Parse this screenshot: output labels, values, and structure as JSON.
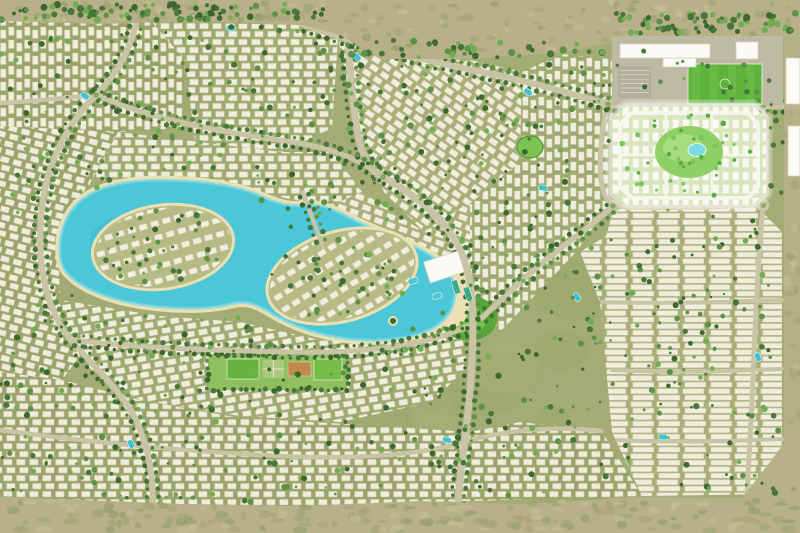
{
  "meta": {
    "kind": "aerial-masterplan",
    "subject": "rendered aerial master plan of a desert residential community with a turquoise lagoon, villa and townhouse districts, a highlighted new-phase parcel, and a school / sports complex"
  },
  "canvas": {
    "w": 800,
    "h": 533
  },
  "palette": {
    "ground": "#a4ac75",
    "groundDark": "#98a269",
    "groundLight": "#afb57e",
    "desert": "#b7b088",
    "desertDark": "#a5a276",
    "desertLight": "#c7c098",
    "scrub": "#8f9a66",
    "scrub2": "#9aa371",
    "road": "#cac4a6",
    "roadCenter": "#86a85c",
    "house": "#f3f0e2",
    "houseStroke": "#d4ceb4",
    "tree": "#47763a",
    "treeDark": "#3a682f",
    "treeLight": "#5d9147",
    "treeBright": "#70ae52",
    "water": "#4cc7d7",
    "waterDeep": "#35bccf",
    "waterLight": "#7edae4",
    "sand": "#ecdfb4",
    "parcelGround": "#d7e7bb",
    "parcelRoad": "#f6f6ef",
    "parcelPark": "#8ed066",
    "parcelParkLight": "#a7dc80",
    "pond": "#7bdbe4",
    "parcelTree": "#58ab44",
    "parcelTree2": "#7ac561",
    "field": "#5fb33c",
    "fieldLight": "#72c14c",
    "paved": "#bdbaa4",
    "parking": "#b2af9d",
    "white": "#fbfaf5",
    "bldgStroke": "#d8d4c0",
    "court": "#c08a4c",
    "lawn": "#68b33f",
    "lawnLight": "#77bd4a",
    "garden": "#a9c97c",
    "parkGreen": "#8fbf5e",
    "poolEdge": "#eef2e8"
  },
  "desert": {
    "top": "M0,0 L800,0 L800,36 L700,40 L620,41 L560,53 L470,59 L380,59 L340,35 L302,25 L200,21 L100,24 L0,21 Z",
    "bottom": "M0,533 L0,497 L80,500 L180,504 L300,506 L420,501 L520,504 L642,497 L742,498 L800,499 L800,533 Z",
    "right": "M784,36 L800,36 L800,499 L784,499 Z",
    "corner": "M800,420 C780,450 760,475 742,498 L800,499 Z",
    "topEdge": [
      [
        0,
        22
      ],
      [
        300,
        25
      ],
      [
        340,
        36
      ],
      [
        380,
        59
      ],
      [
        560,
        53
      ],
      [
        620,
        41
      ],
      [
        800,
        37
      ]
    ],
    "bottomEdge": [
      [
        0,
        496
      ],
      [
        180,
        503
      ],
      [
        300,
        505
      ],
      [
        420,
        500
      ],
      [
        642,
        496
      ],
      [
        800,
        498
      ]
    ]
  },
  "districts": [
    {
      "name": "district-top-left-a",
      "pts": [
        [
          0,
          20
        ],
        [
          152,
          22
        ],
        [
          185,
          60
        ],
        [
          182,
          128
        ],
        [
          118,
          132
        ],
        [
          0,
          126
        ]
      ],
      "angle": 90,
      "type": "villa",
      "tone": "#9aa46b"
    },
    {
      "name": "district-top-left-b",
      "pts": [
        [
          152,
          22
        ],
        [
          302,
          25
        ],
        [
          338,
          38
        ],
        [
          332,
          128
        ],
        [
          282,
          152
        ],
        [
          196,
          150
        ],
        [
          185,
          60
        ]
      ],
      "angle": 0,
      "type": "villa",
      "tone": "#a0aa70"
    },
    {
      "name": "district-top-center",
      "pts": [
        [
          338,
          38
        ],
        [
          382,
          58
        ],
        [
          470,
          60
        ],
        [
          522,
          72
        ],
        [
          520,
          162
        ],
        [
          472,
          202
        ],
        [
          424,
          232
        ],
        [
          384,
          192
        ],
        [
          356,
          122
        ]
      ],
      "angle": 35,
      "type": "villa",
      "tone": "#a7af77"
    },
    {
      "name": "district-center-right",
      "pts": [
        [
          522,
          72
        ],
        [
          562,
          54
        ],
        [
          618,
          60
        ],
        [
          612,
          104
        ],
        [
          608,
          206
        ],
        [
          576,
          252
        ],
        [
          538,
          292
        ],
        [
          500,
          332
        ],
        [
          470,
          312
        ],
        [
          442,
          252
        ],
        [
          472,
          202
        ],
        [
          520,
          162
        ]
      ],
      "angle": 90,
      "type": "villa",
      "tone": "#a0aa70"
    },
    {
      "name": "district-right-grid",
      "pts": [
        [
          614,
          208
        ],
        [
          758,
          208
        ],
        [
          782,
          232
        ],
        [
          782,
          494
        ],
        [
          642,
          496
        ],
        [
          612,
          432
        ],
        [
          600,
          302
        ],
        [
          580,
          252
        ],
        [
          606,
          236
        ]
      ],
      "angle": 0,
      "type": "town",
      "tone": "#a7af77"
    },
    {
      "name": "district-west",
      "pts": [
        [
          0,
          126
        ],
        [
          118,
          132
        ],
        [
          92,
          180
        ],
        [
          58,
          240
        ],
        [
          60,
          300
        ],
        [
          92,
          340
        ],
        [
          62,
          380
        ],
        [
          0,
          372
        ]
      ],
      "angle": 15,
      "type": "villa",
      "tone": "#9aa46b"
    },
    {
      "name": "district-north-lagoon",
      "pts": [
        [
          118,
          132
        ],
        [
          282,
          152
        ],
        [
          332,
          152
        ],
        [
          362,
          192
        ],
        [
          330,
          206
        ],
        [
          252,
          192
        ],
        [
          160,
          182
        ],
        [
          92,
          180
        ]
      ],
      "angle": 0,
      "type": "villa",
      "tone": "#a0aa70"
    },
    {
      "name": "district-south-lagoon",
      "pts": [
        [
          60,
          300
        ],
        [
          160,
          316
        ],
        [
          240,
          322
        ],
        [
          320,
          340
        ],
        [
          402,
          346
        ],
        [
          456,
          326
        ],
        [
          472,
          362
        ],
        [
          432,
          402
        ],
        [
          340,
          422
        ],
        [
          240,
          416
        ],
        [
          140,
          400
        ],
        [
          92,
          370
        ],
        [
          62,
          340
        ]
      ],
      "angle": -10,
      "type": "villa",
      "tone": "#a0aa70"
    },
    {
      "name": "district-bottom",
      "pts": [
        [
          0,
          372
        ],
        [
          62,
          380
        ],
        [
          140,
          400
        ],
        [
          240,
          418
        ],
        [
          380,
          426
        ],
        [
          470,
          432
        ],
        [
          520,
          422
        ],
        [
          602,
          432
        ],
        [
          642,
          496
        ],
        [
          300,
          506
        ],
        [
          180,
          504
        ],
        [
          80,
          500
        ],
        [
          0,
          496
        ]
      ],
      "angle": 0,
      "type": "villa",
      "tone": "#9aa46b"
    },
    {
      "name": "district-east-lagoon",
      "pts": [
        [
          362,
          192
        ],
        [
          424,
          232
        ],
        [
          470,
          202
        ],
        [
          470,
          312
        ],
        [
          456,
          326
        ],
        [
          402,
          346
        ],
        [
          330,
          340
        ],
        [
          300,
          322
        ],
        [
          330,
          206
        ]
      ],
      "angle": 20,
      "type": "villa",
      "tone": "#a7af77"
    }
  ],
  "lagoon": {
    "beach": {
      "cx": 448,
      "cy": 294,
      "rx": 22,
      "ry": 34,
      "rot": -10
    },
    "water": "M60,255 C58,224 72,202 96,191 C122,180 152,179 186,181 C221,183 246,189 263,197 C279,204 291,207 306,205 C323,203 341,213 356,221 C379,232 411,242 433,257 C451,269 459,287 453,305 C447,323 429,333 406,337 C381,342 351,341 326,335 C303,330 286,322 269,312 C256,304 246,300 231,304 C211,309 186,310 151,306 C116,302 86,291 71,277 C63,270 61,264 60,255 Z",
    "deepBlobs": [
      [
        150,
        240,
        60,
        28
      ],
      [
        330,
        283,
        55,
        25
      ]
    ],
    "islands": [
      {
        "cx": 163,
        "cy": 247,
        "rx": 71,
        "ry": 42,
        "rot": -8
      },
      {
        "cx": 342,
        "cy": 276,
        "rx": 77,
        "ry": 45,
        "rot": -16
      }
    ],
    "tiny": {
      "cx": 393,
      "cy": 321,
      "r": 5
    }
  },
  "roads": [
    {
      "name": "main-boulevard",
      "d": "M345,0 C350,60 352,120 362,150 C370,170 376,174 383,177",
      "w": 7,
      "trees": true
    },
    {
      "name": "east-artery",
      "d": "M383,177 C412,192 440,216 455,240 C468,262 473,290 473,320 C473,370 468,420 461,470 C458,494 457,512 457,533",
      "w": 7,
      "trees": true
    },
    {
      "name": "top-cross-road",
      "d": "M302,24 C362,46 432,62 482,72 C532,82 572,94 608,104 C652,110 702,108 763,106 C780,106 792,107 800,107",
      "w": 6,
      "trees": true
    },
    {
      "name": "parcel-left-road",
      "d": "M608,104 C601,130 599,160 601,180 C603,194 607,200 613,206",
      "w": 5,
      "trees": false
    },
    {
      "name": "parcel-bottom-road",
      "d": "M613,206 C660,209 712,207 763,205",
      "w": 5,
      "trees": false
    },
    {
      "name": "parcel-right-road",
      "d": "M763,106 C766,140 767,174 763,205",
      "w": 5,
      "trees": false
    },
    {
      "name": "parcel-diagonal-road",
      "d": "M613,206 C592,226 562,246 536,268 C516,286 496,304 482,318",
      "w": 5.5,
      "trees": true
    },
    {
      "name": "right-vertical-road",
      "d": "M763,205 C758,260 755,330 752,400 C750,440 748,472 747,498",
      "w": 5,
      "trees": false
    },
    {
      "name": "west-loop-road",
      "d": "M140,0 C136,40 121,70 96,95 C66,125 46,165 41,215 C37,265 46,310 71,340 C96,370 121,390 136,420 C149,448 153,475 153,505",
      "w": 6,
      "trees": true
    },
    {
      "name": "west-horizontal-road",
      "d": "M0,103 C30,102 60,98 96,95",
      "w": 4.5,
      "trees": false
    },
    {
      "name": "north-shore-road",
      "d": "M96,95 C152,120 222,132 292,142 C332,148 362,160 383,177",
      "w": 5,
      "trees": true
    },
    {
      "name": "south-shore-road",
      "d": "M71,340 C140,348 212,350 282,352 C352,354 422,348 468,326",
      "w": 5,
      "trees": true
    },
    {
      "name": "bottom-collector-road",
      "d": "M0,430 C80,441 180,451 280,456 C380,461 441,450 471,440 C511,429 561,426 601,431",
      "w": 4.5,
      "trees": false
    },
    {
      "name": "grid-street-1",
      "d": "M602,302 C662,304 722,302 782,300",
      "w": 4,
      "trees": false
    },
    {
      "name": "grid-street-2",
      "d": "M612,370 C672,373 732,371 782,369",
      "w": 4,
      "trees": false
    },
    {
      "name": "grid-street-3",
      "d": "M617,440 C672,443 732,441 782,439",
      "w": 4,
      "trees": false
    },
    {
      "name": "school-access-road",
      "d": "M621,38 C620,68 618,88 612,104",
      "w": 4.5,
      "trees": false
    },
    {
      "name": "lagoon-causeway",
      "d": "M303,192 L323,247",
      "w": 4,
      "trees": true
    }
  ],
  "roundabouts": [
    [
      383,
      177
    ],
    [
      608,
      104
    ],
    [
      763,
      106
    ],
    [
      613,
      206
    ],
    [
      763,
      205
    ],
    [
      96,
      95
    ]
  ],
  "school": {
    "ground": {
      "x": 612,
      "y": 36,
      "w": 171,
      "h": 69
    },
    "buildings": [
      [
        620,
        44,
        90,
        14
      ],
      [
        663,
        58,
        33,
        9
      ],
      [
        736,
        42,
        22,
        17
      ],
      [
        786,
        58,
        14,
        46
      ],
      [
        788,
        126,
        12,
        50
      ]
    ],
    "parking": {
      "x": 618,
      "y": 66,
      "w": 33,
      "h": 32
    },
    "field": {
      "x": 688,
      "y": 64,
      "w": 74,
      "h": 40
    }
  },
  "parcel": {
    "outline": "M612,118 L627,106 L753,106 L766,118 L766,193 L753,205 L627,205 L612,193 Z",
    "ring": "M620,124 L632,113 L748,113 L758,124 L758,187 L748,198 L632,198 L620,187 Z",
    "cross": [
      "M666,113 L666,198",
      "M712,113 L712,198",
      "M620,155 L758,155"
    ],
    "park": {
      "cx": 689,
      "cy": 152,
      "rx": 34,
      "ry": 26
    },
    "parkBlob": {
      "cx": 683,
      "cy": 148,
      "rx": 20,
      "ry": 14
    },
    "pond": {
      "cx": 697,
      "cy": 150,
      "rx": 9,
      "ry": 6.5
    },
    "treeCount": 40
  },
  "parks": {
    "linear": {
      "x": 208,
      "y": 354,
      "w": 140,
      "h": 36,
      "lawn1": [
        227,
        359,
        32,
        20
      ],
      "garden": [
        263,
        360,
        21,
        18
      ],
      "court": [
        288,
        362,
        23,
        14
      ],
      "lawn2": [
        314,
        359,
        28,
        21
      ]
    },
    "centerBlob": {
      "outer": "M441,312 C444,299 462,291 479,297 C496,303 501,315 495,327 C489,339 470,344 455,338 C443,333 438,323 441,312 Z",
      "inner": "M450,315 C455,306 468,303 477,308 C486,313 488,321 483,328 C477,335 465,336 457,331 C451,327 448,321 450,315 Z"
    },
    "smallPark": {
      "cx": 530,
      "cy": 147,
      "rx": 13,
      "ry": 11
    }
  },
  "clubhouse": {
    "rect": [
      426,
      256,
      36,
      22,
      -18
    ],
    "pools": [
      [
        413,
        281
      ],
      [
        437,
        296
      ]
    ],
    "courts": [
      [
        456,
        287
      ],
      [
        468,
        294
      ]
    ]
  },
  "pools": [
    [
      85,
      96
    ],
    [
      231,
      28
    ],
    [
      357,
      57
    ],
    [
      528,
      92
    ],
    [
      543,
      188
    ],
    [
      131,
      444
    ],
    [
      758,
      357
    ],
    [
      577,
      297
    ],
    [
      663,
      437
    ],
    [
      447,
      440
    ]
  ],
  "trees": {
    "seed": 42,
    "scatter": 950,
    "hedgeTop": [
      0,
      330,
      4,
      20,
      95
    ],
    "hedgeTopRight": [
      612,
      800,
      13,
      34,
      70
    ],
    "hedgeMid": [
      340,
      615,
      40,
      58,
      45
    ],
    "islandTrees": 26,
    "schoolKeep": 0.25,
    "lagoonEllipses": [
      [
        165,
        245,
        118,
        66
      ],
      [
        345,
        280,
        112,
        60
      ]
    ],
    "islandEllipses": [
      [
        163,
        247,
        66,
        38
      ],
      [
        342,
        276,
        72,
        41
      ]
    ],
    "parcelBBox": [
      610,
      104,
      158,
      103
    ],
    "parcelEllipse": [
      689,
      155,
      70,
      44
    ]
  }
}
